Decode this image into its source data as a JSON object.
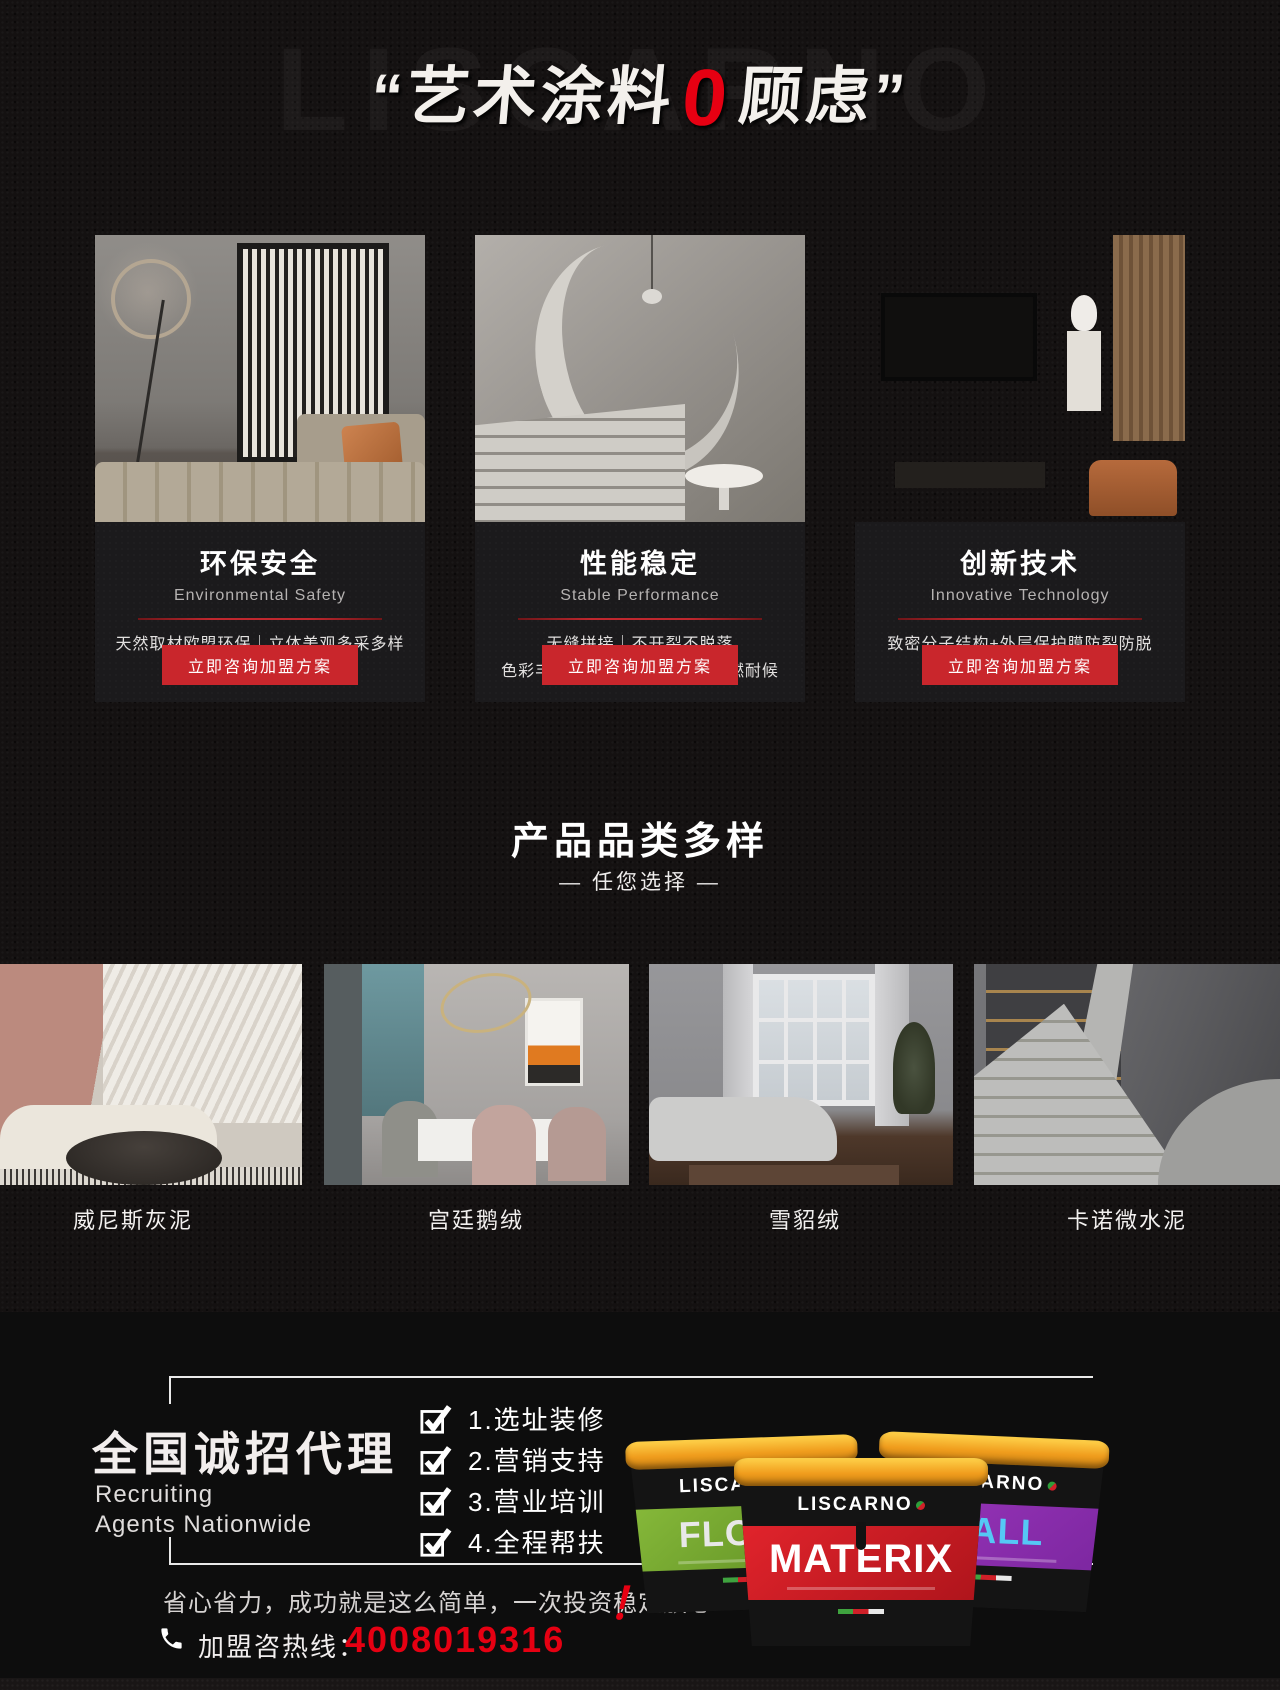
{
  "header": {
    "watermark": "LISCARNO",
    "title_prefix": "“艺术涂料",
    "title_zero": "0",
    "title_suffix": "顾虑”"
  },
  "cards": [
    {
      "title": "环保安全",
      "subtitle": "Environmental Safety",
      "line1": "天然取材欧盟环保｜立体美观多采多样",
      "line2": "耐擦洗防潮防毒",
      "button": "立即咨询加盟方案"
    },
    {
      "title": "性能稳定",
      "subtitle": "Stable Performance",
      "line1": "无缝拼接｜不开裂不脱落",
      "line2": "色彩丰富持久弥新Ⅰ水性涂料阻燃耐候",
      "button": "立即咨询加盟方案"
    },
    {
      "title": "创新技术",
      "subtitle": "Innovative Technology",
      "line1": "致密分子结构+外层保护膜防裂防脱",
      "line2": "天然树脂萃取无污染",
      "button": "立即咨询加盟方案"
    }
  ],
  "products": {
    "heading": "产品品类多样",
    "subheading": "— 任您选择 —",
    "items": [
      {
        "label": "威尼斯灰泥"
      },
      {
        "label": "宫廷鹅绒"
      },
      {
        "label": "雪貂绒"
      },
      {
        "label": "卡诺微水泥"
      }
    ]
  },
  "agency": {
    "title": "全国诚招代理",
    "subtitle_line1": "Recruiting",
    "subtitle_line2": "Agents Nationwide",
    "checklist": [
      "1.选址装修",
      "2.营销支持",
      "3.营业培训",
      "4.全程帮扶"
    ],
    "slogan": "省心省力，成功就是这么简单，一次投资稳定放心",
    "exclamation": "！",
    "hotline_label": "加盟咨热线：",
    "hotline_number": "4008019316",
    "buckets": [
      {
        "brand": "LISCARNO",
        "name": "FLOOR"
      },
      {
        "brand": "LISCARNO",
        "name": "MATERIX"
      },
      {
        "brand": "LISCARNO",
        "name": "WALL"
      }
    ]
  },
  "colors": {
    "accent_red": "#e60012",
    "button_red": "#c9262c",
    "bucket_green": "#6da02c",
    "bucket_red": "#d8232a",
    "bucket_purple": "#8b2fa8",
    "wall_text_blue": "#55c8f5",
    "page_background": "#141111",
    "bottom_section_background": "#0d0d0d"
  }
}
